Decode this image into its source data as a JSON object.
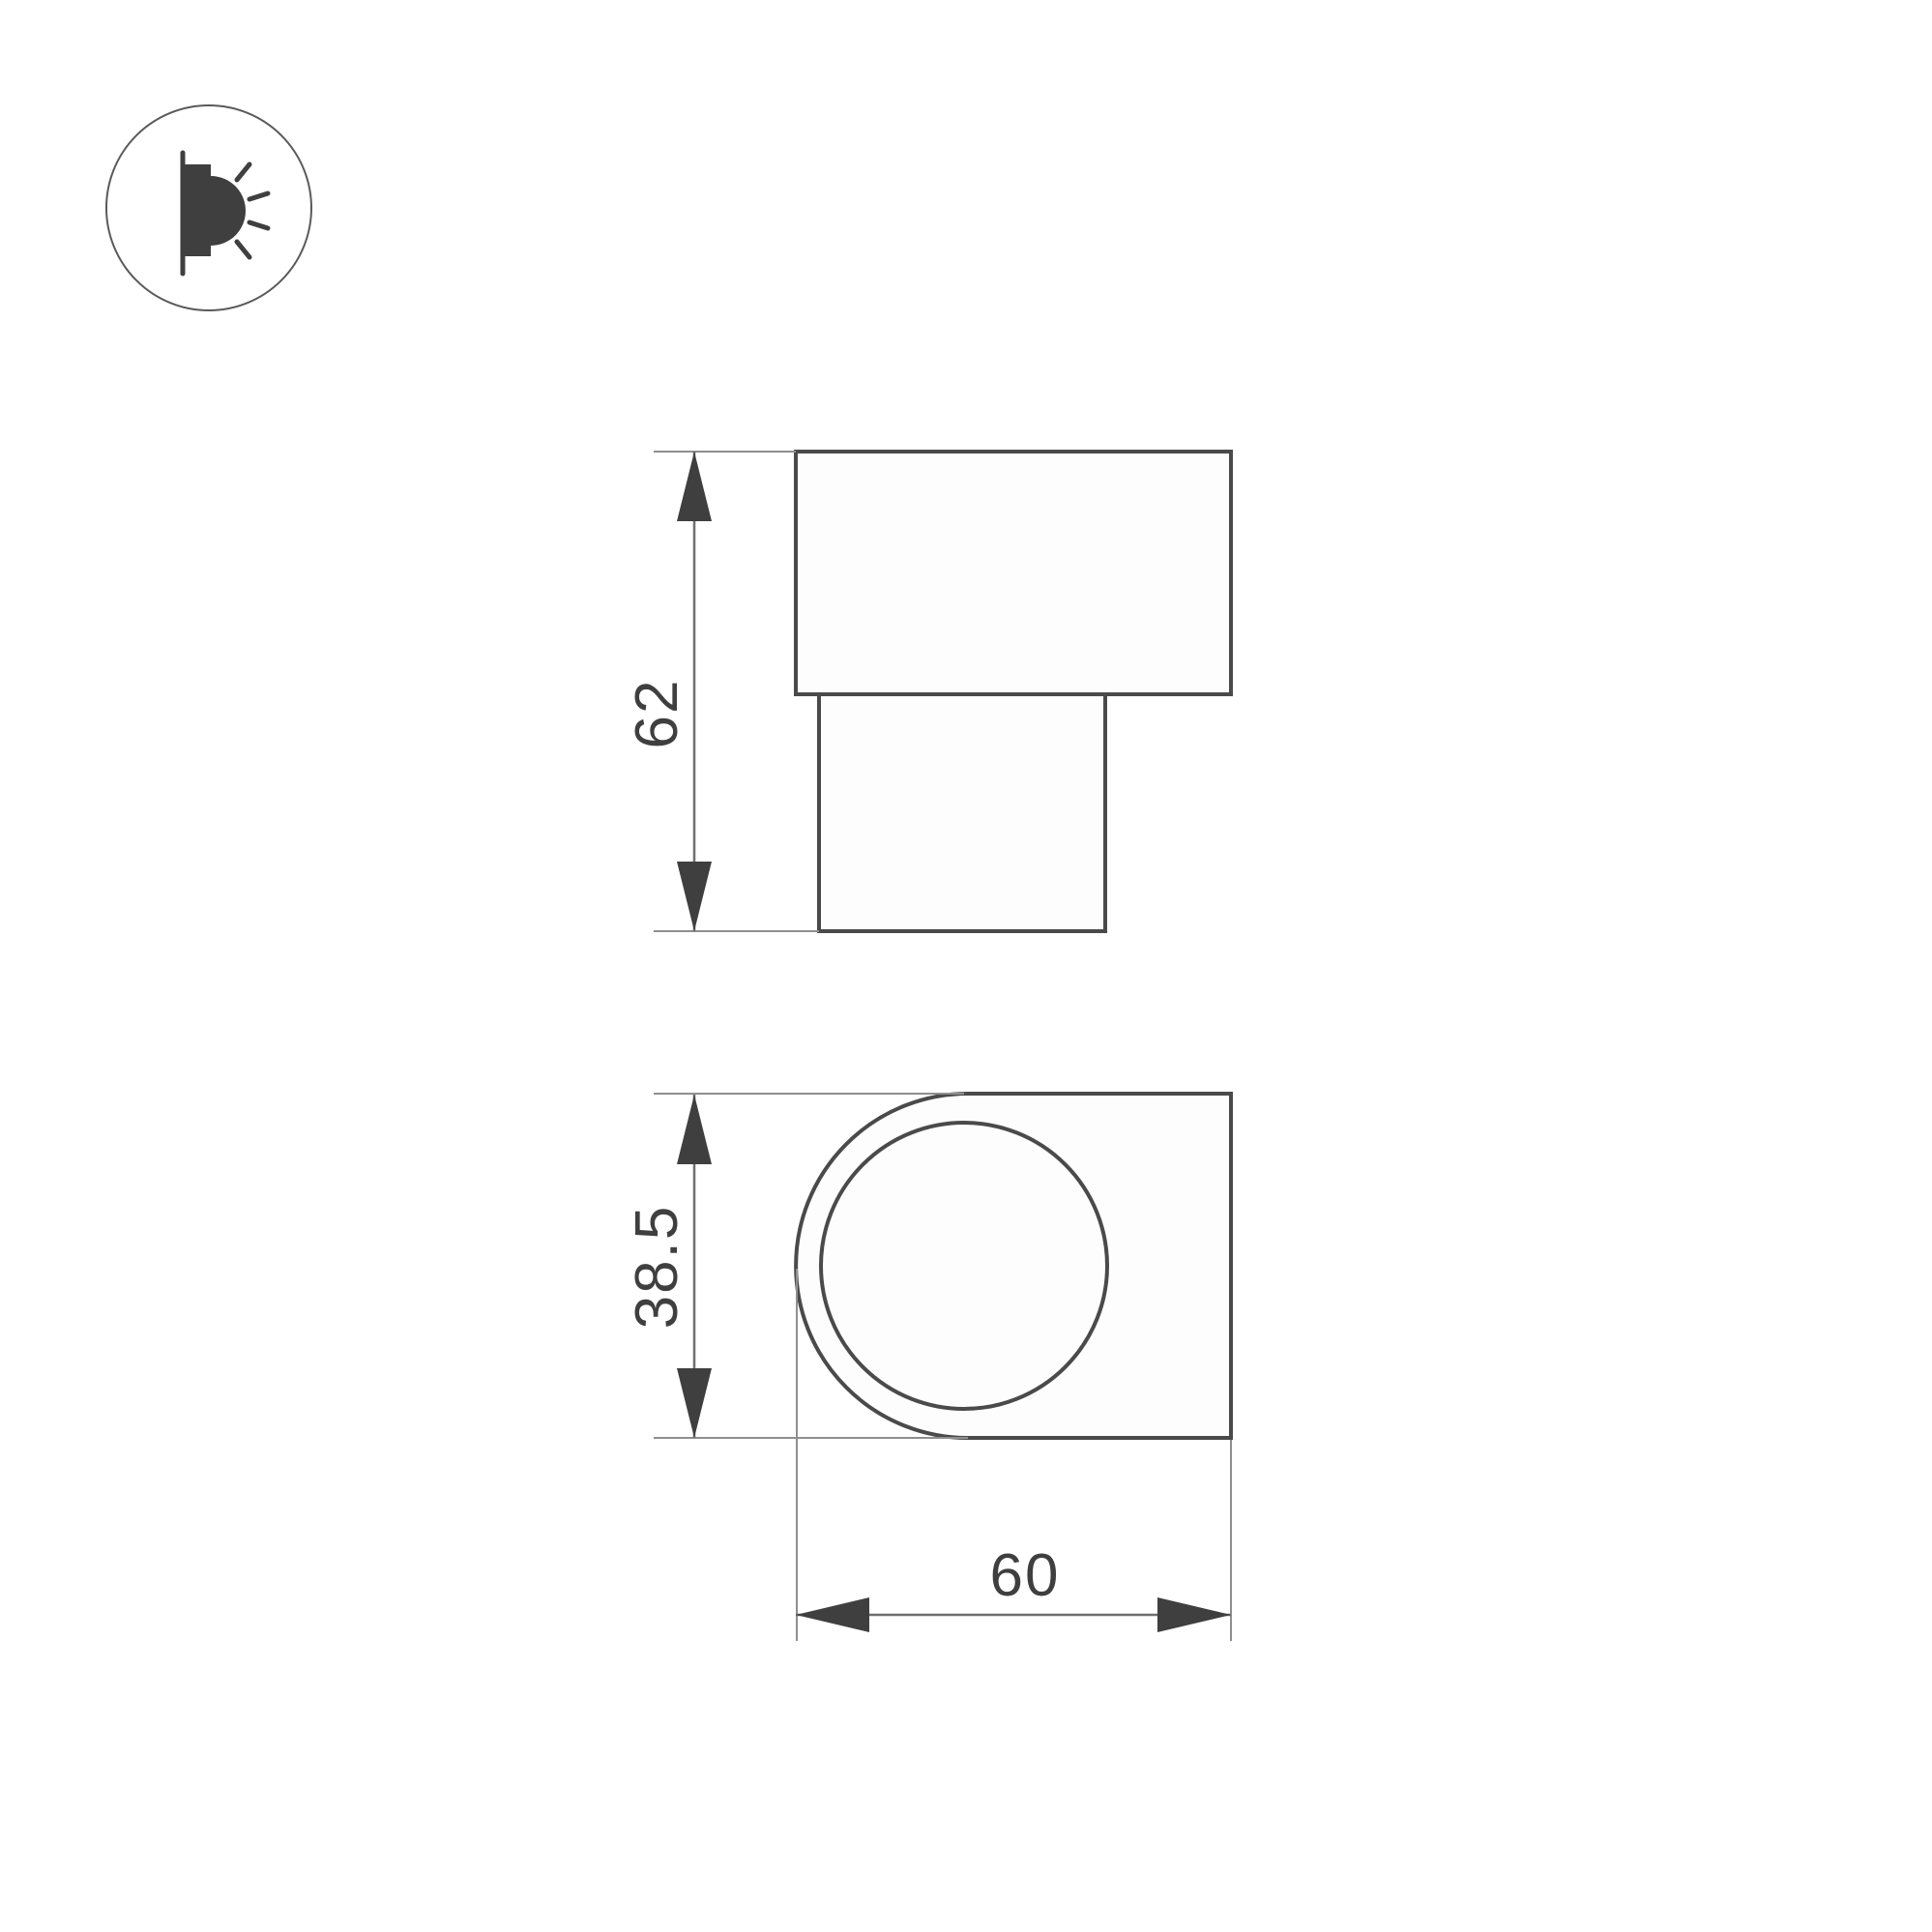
{
  "icon": {
    "name": "wall-lamp-emitting-light-icon"
  },
  "front_view": {
    "height_label": "62"
  },
  "side_view": {
    "height_label": "38.5",
    "width_label": "60"
  },
  "colors": {
    "background": "#ffffff",
    "outline": "#4a4a4a",
    "dimension_line": "#6e6e6e",
    "extension_line": "#8f8f8f",
    "text": "#3f3f3f"
  }
}
